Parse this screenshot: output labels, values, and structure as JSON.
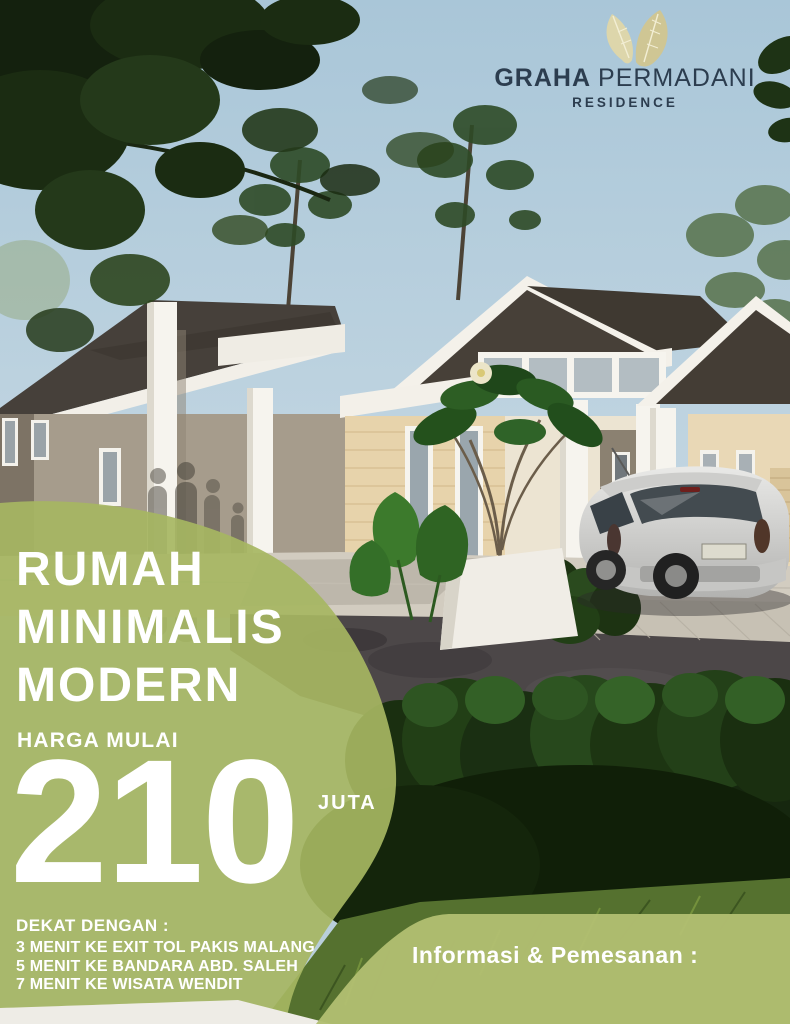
{
  "brand": {
    "primary": "GRAHA",
    "secondary": "PERMADANI",
    "subtitle": "RESIDENCE"
  },
  "headline": {
    "line1": "RUMAH",
    "line2": "MINIMALIS",
    "line3": "MODERN"
  },
  "price": {
    "label": "HARGA MULAI",
    "amount": "210",
    "unit": "JUTA"
  },
  "locations": {
    "title": "DEKAT DENGAN :",
    "items": [
      "3 MENIT KE EXIT TOL PAKIS MALANG",
      "5 MENIT KE BANDARA ABD. SALEH",
      "7 MENIT KE WISATA WENDIT"
    ]
  },
  "contact": {
    "label": "Informasi & Pemesanan :"
  },
  "colors": {
    "accent_green": "#a6b662",
    "panel_green": "#b1be71",
    "logo_navy": "#2c3d4f",
    "leaf_gold": "#cfc694",
    "text_white": "#ffffff"
  }
}
